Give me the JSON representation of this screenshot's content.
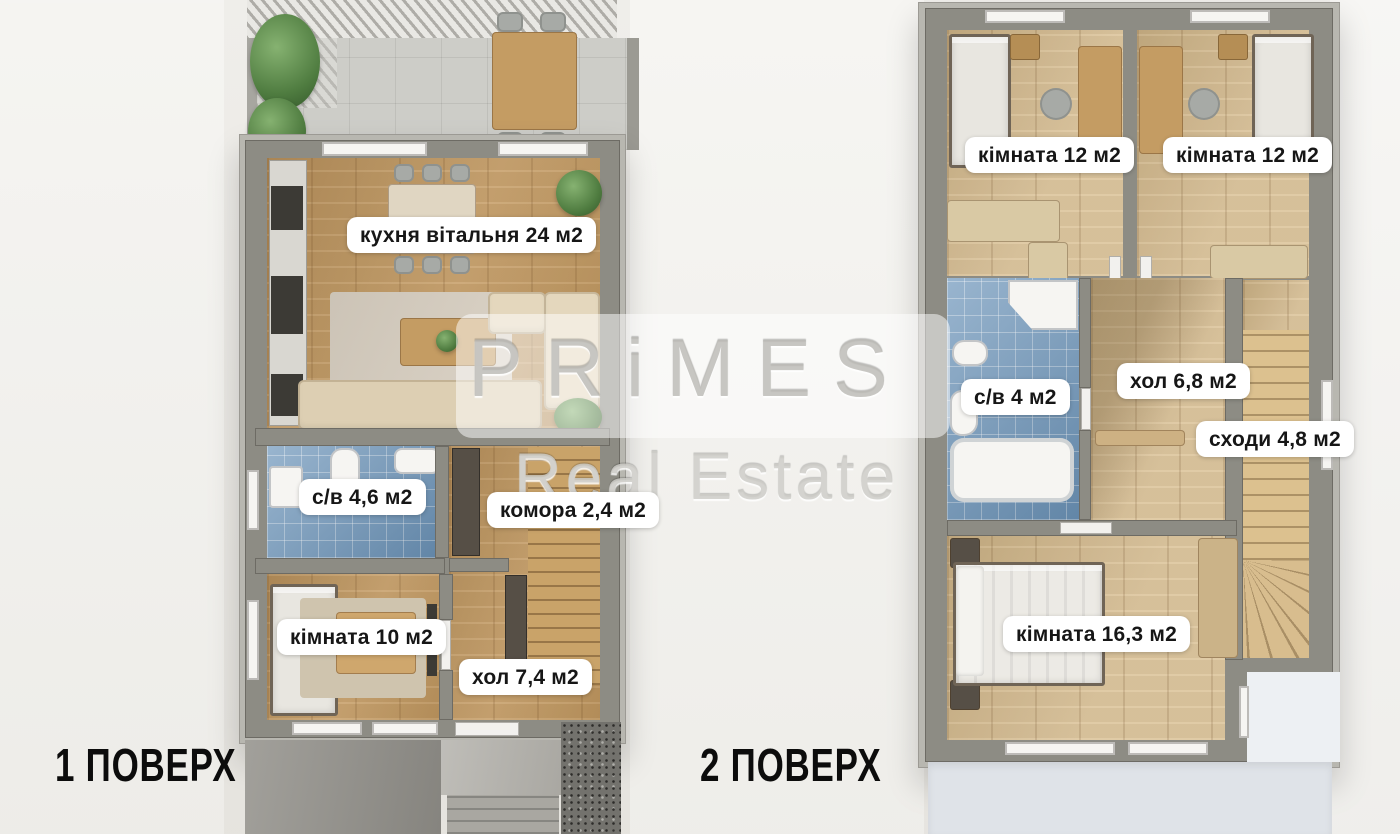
{
  "image": {
    "type": "real-estate floor plan render, top view, two floors",
    "background": "#ebe9e4"
  },
  "watermark": {
    "line1": "PRiMES",
    "line2": "Real Estate"
  },
  "floors": [
    {
      "title": "1 ПОВЕРХ",
      "rooms": [
        {
          "name": "кухня вітальня",
          "area": "24 м2",
          "label": "кухня вітальня 24 м2"
        },
        {
          "name": "с/в",
          "area": "4,6 м2",
          "label": "с/в 4,6 м2"
        },
        {
          "name": "комора",
          "area": "2,4 м2",
          "label": "комора 2,4 м2"
        },
        {
          "name": "кімната",
          "area": "10 м2",
          "label": "кімната 10 м2"
        },
        {
          "name": "хол",
          "area": "7,4 м2",
          "label": "хол 7,4 м2"
        }
      ]
    },
    {
      "title": "2 ПОВЕРХ",
      "rooms": [
        {
          "name": "кімната",
          "area": "12 м2",
          "label": "кімната 12 м2"
        },
        {
          "name": "кімната",
          "area": "12 м2",
          "label": "кімната 12 м2"
        },
        {
          "name": "с/в",
          "area": "4 м2",
          "label": "с/в 4 м2"
        },
        {
          "name": "хол",
          "area": "6,8 м2",
          "label": "хол 6,8 м2"
        },
        {
          "name": "сходи",
          "area": "4,8 м2",
          "label": "сходи 4,8 м2"
        },
        {
          "name": "кімната",
          "area": "16,3 м2",
          "label": "кімната 16,3 м2"
        }
      ]
    }
  ],
  "colors": {
    "wall": "#8d8c84",
    "wood_floor1": "#c49a61",
    "wood_floor2": "#d9bf92",
    "bathroom_tile": "#6d95ba",
    "label_bg": "#ffffff",
    "label_text": "#161616",
    "title_text": "#0c0c0c",
    "watermark": "#cfcec9"
  }
}
